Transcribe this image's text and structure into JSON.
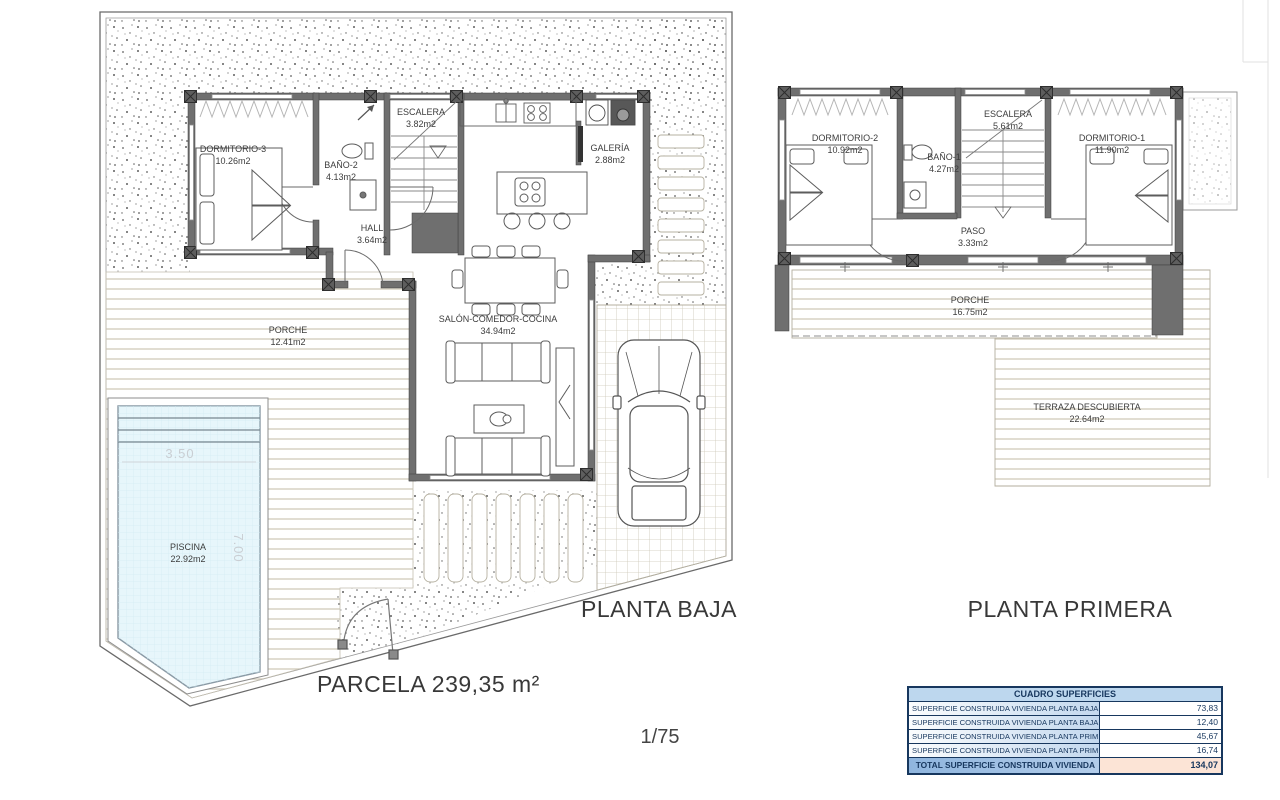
{
  "titles": {
    "planta_baja": "PLANTA BAJA",
    "planta_primera": "PLANTA PRIMERA",
    "parcela": "PARCELA 239,35 m²",
    "escala": "1/75"
  },
  "plan_baja": {
    "rooms": {
      "dormitorio3": {
        "name": "DORMITORIO-3",
        "area": "10.26m2"
      },
      "bano2": {
        "name": "BAÑO-2",
        "area": "4.13m2"
      },
      "escalera": {
        "name": "ESCALERA",
        "area": "3.82m2"
      },
      "galeria": {
        "name": "GALERÍA",
        "area": "2.88m2"
      },
      "hall": {
        "name": "HALL",
        "area": "3.64m2"
      },
      "salon": {
        "name": "SALÓN-COMEDOR-COCINA",
        "area": "34.94m2"
      },
      "porche": {
        "name": "PORCHE",
        "area": "12.41m2"
      },
      "piscina": {
        "name": "PISCINA",
        "area": "22.92m2"
      }
    },
    "pool_dims": {
      "width": "3.50",
      "length": "7.00"
    }
  },
  "plan_primera": {
    "rooms": {
      "dormitorio2": {
        "name": "DORMITORIO-2",
        "area": "10.92m2"
      },
      "bano1": {
        "name": "BAÑO-1",
        "area": "4.27m2"
      },
      "escalera": {
        "name": "ESCALERA",
        "area": "5.61m2"
      },
      "dormitorio1": {
        "name": "DORMITORIO-1",
        "area": "11.90m2"
      },
      "paso": {
        "name": "PASO",
        "area": "3.33m2"
      },
      "porche": {
        "name": "PORCHE",
        "area": "16.75m2"
      },
      "terraza": {
        "name": "TERRAZA DESCUBIERTA",
        "area": "22.64m2"
      }
    }
  },
  "surface_table": {
    "header": "CUADRO SUPERFICIES",
    "rows": [
      {
        "label": "SUPERFICIE CONSTRUIDA VIVIENDA PLANTA BAJA 100%",
        "value": "73,83"
      },
      {
        "label": "SUPERFICIE CONSTRUIDA VIVIENDA PLANTA BAJA 50%",
        "value": "12,40"
      },
      {
        "label": "SUPERFICIE CONSTRUIDA VIVIENDA PLANTA PRIMERA 100%",
        "value": "45,67"
      },
      {
        "label": "SUPERFICIE CONSTRUIDA VIVIENDA PLANTA PRIMERA 50%",
        "value": "16,74"
      }
    ],
    "total": {
      "label": "TOTAL SUPERFICIE CONSTRUIDA VIVIENDA",
      "value": "134,07"
    }
  },
  "colors": {
    "wall": "#6f6f6f",
    "pool_water": "#e7f6fb",
    "table_header_bg": "#bdd7ee",
    "table_text": "#17375e",
    "total_value_bg": "#fce4d6"
  }
}
